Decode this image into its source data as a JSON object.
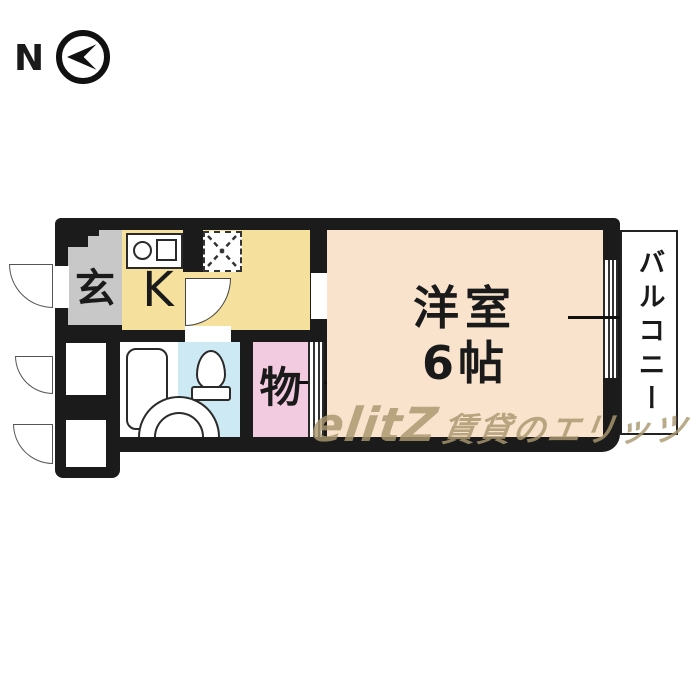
{
  "compass": {
    "label": "N"
  },
  "floor_plan": {
    "entrance": {
      "label": "玄"
    },
    "kitchen": {
      "label": "K"
    },
    "storage": {
      "label": "物"
    },
    "western_room": {
      "name": "洋室",
      "size": "6帖"
    },
    "balcony": {
      "label": "バルコニー"
    }
  },
  "watermark": {
    "logo": "elitZ",
    "text": "賃貸のエリッツ"
  },
  "colors": {
    "wall": "#1b1b1b",
    "entrance": "#c8c8c8",
    "kitchen": "#f5e19d",
    "western_room": "#fae3cc",
    "storage": "#f3cbe0",
    "bathroom": "#cde9f4",
    "watermark": "#aa9870"
  }
}
